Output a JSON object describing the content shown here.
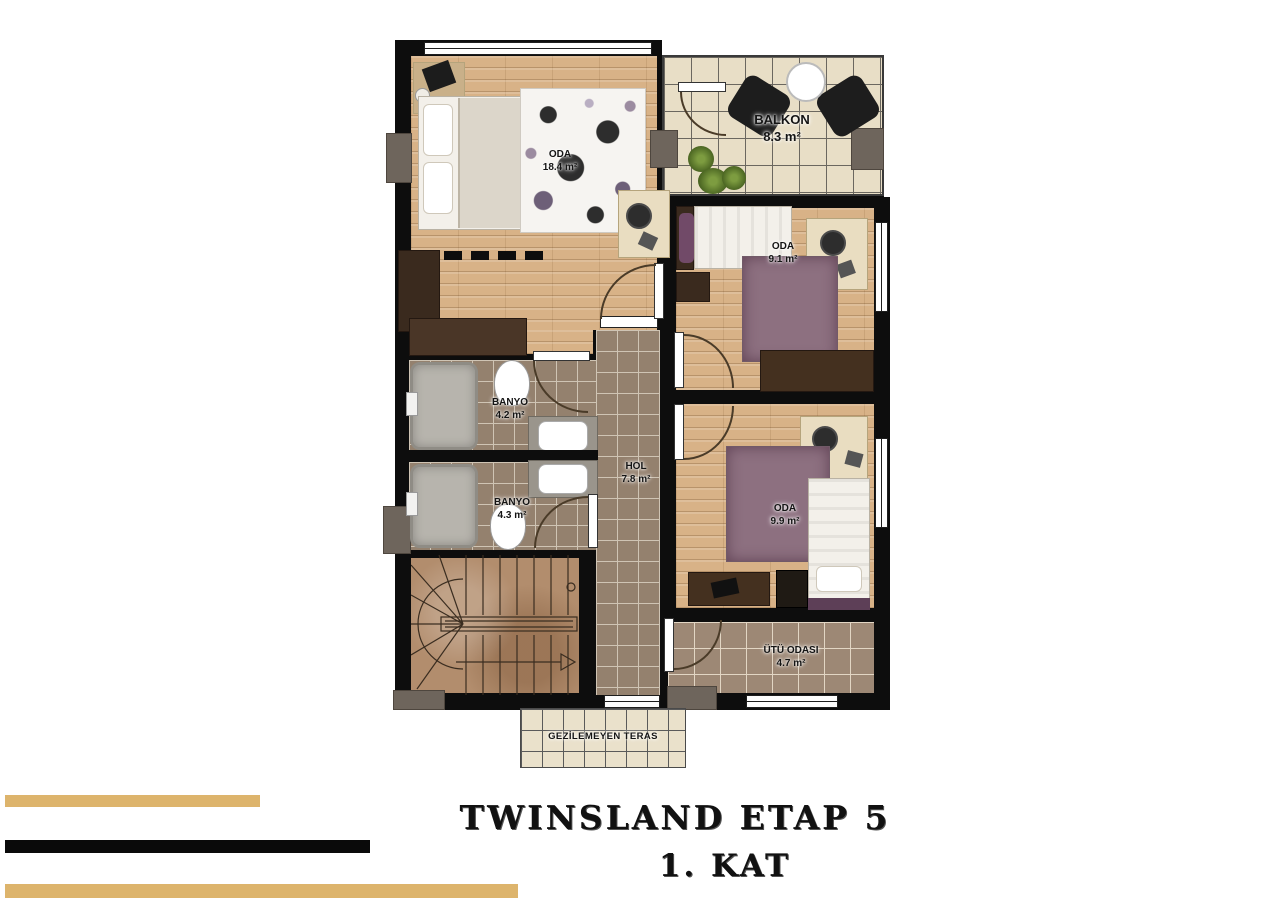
{
  "title": {
    "line1": "TWINSLAND ETAP 5",
    "line2": "1. KAT"
  },
  "plan": {
    "rooms": {
      "master": {
        "name": "ODA",
        "area": "18.4 m²"
      },
      "balcony": {
        "name": "BALKON",
        "area": "8.3 m²"
      },
      "bedroom2": {
        "name": "ODA",
        "area": "9.1 m²"
      },
      "bath1": {
        "name": "BANYO",
        "area": "4.2 m²"
      },
      "bath2": {
        "name": "BANYO",
        "area": "4.3 m²"
      },
      "hall": {
        "name": "HOL",
        "area": "7.8 m²"
      },
      "bedroom3": {
        "name": "ODA",
        "area": "9.9 m²"
      },
      "ironing": {
        "name": "ÜTÜ ODASI",
        "area": "4.7 m²"
      },
      "terrace": {
        "name": "GEZİLEMEYEN TERAS"
      }
    }
  },
  "colors": {
    "wall": "#0d0d0d",
    "wood_floor": "#d8b287",
    "tile_floor": "#94816e",
    "balcony_tile": "#e8dec6",
    "terrace_tile": "#eae1cb",
    "accent_gold": "#ddb46c",
    "furniture_dark": "#3a2a1e",
    "rug_mauve": "#8d7080"
  }
}
